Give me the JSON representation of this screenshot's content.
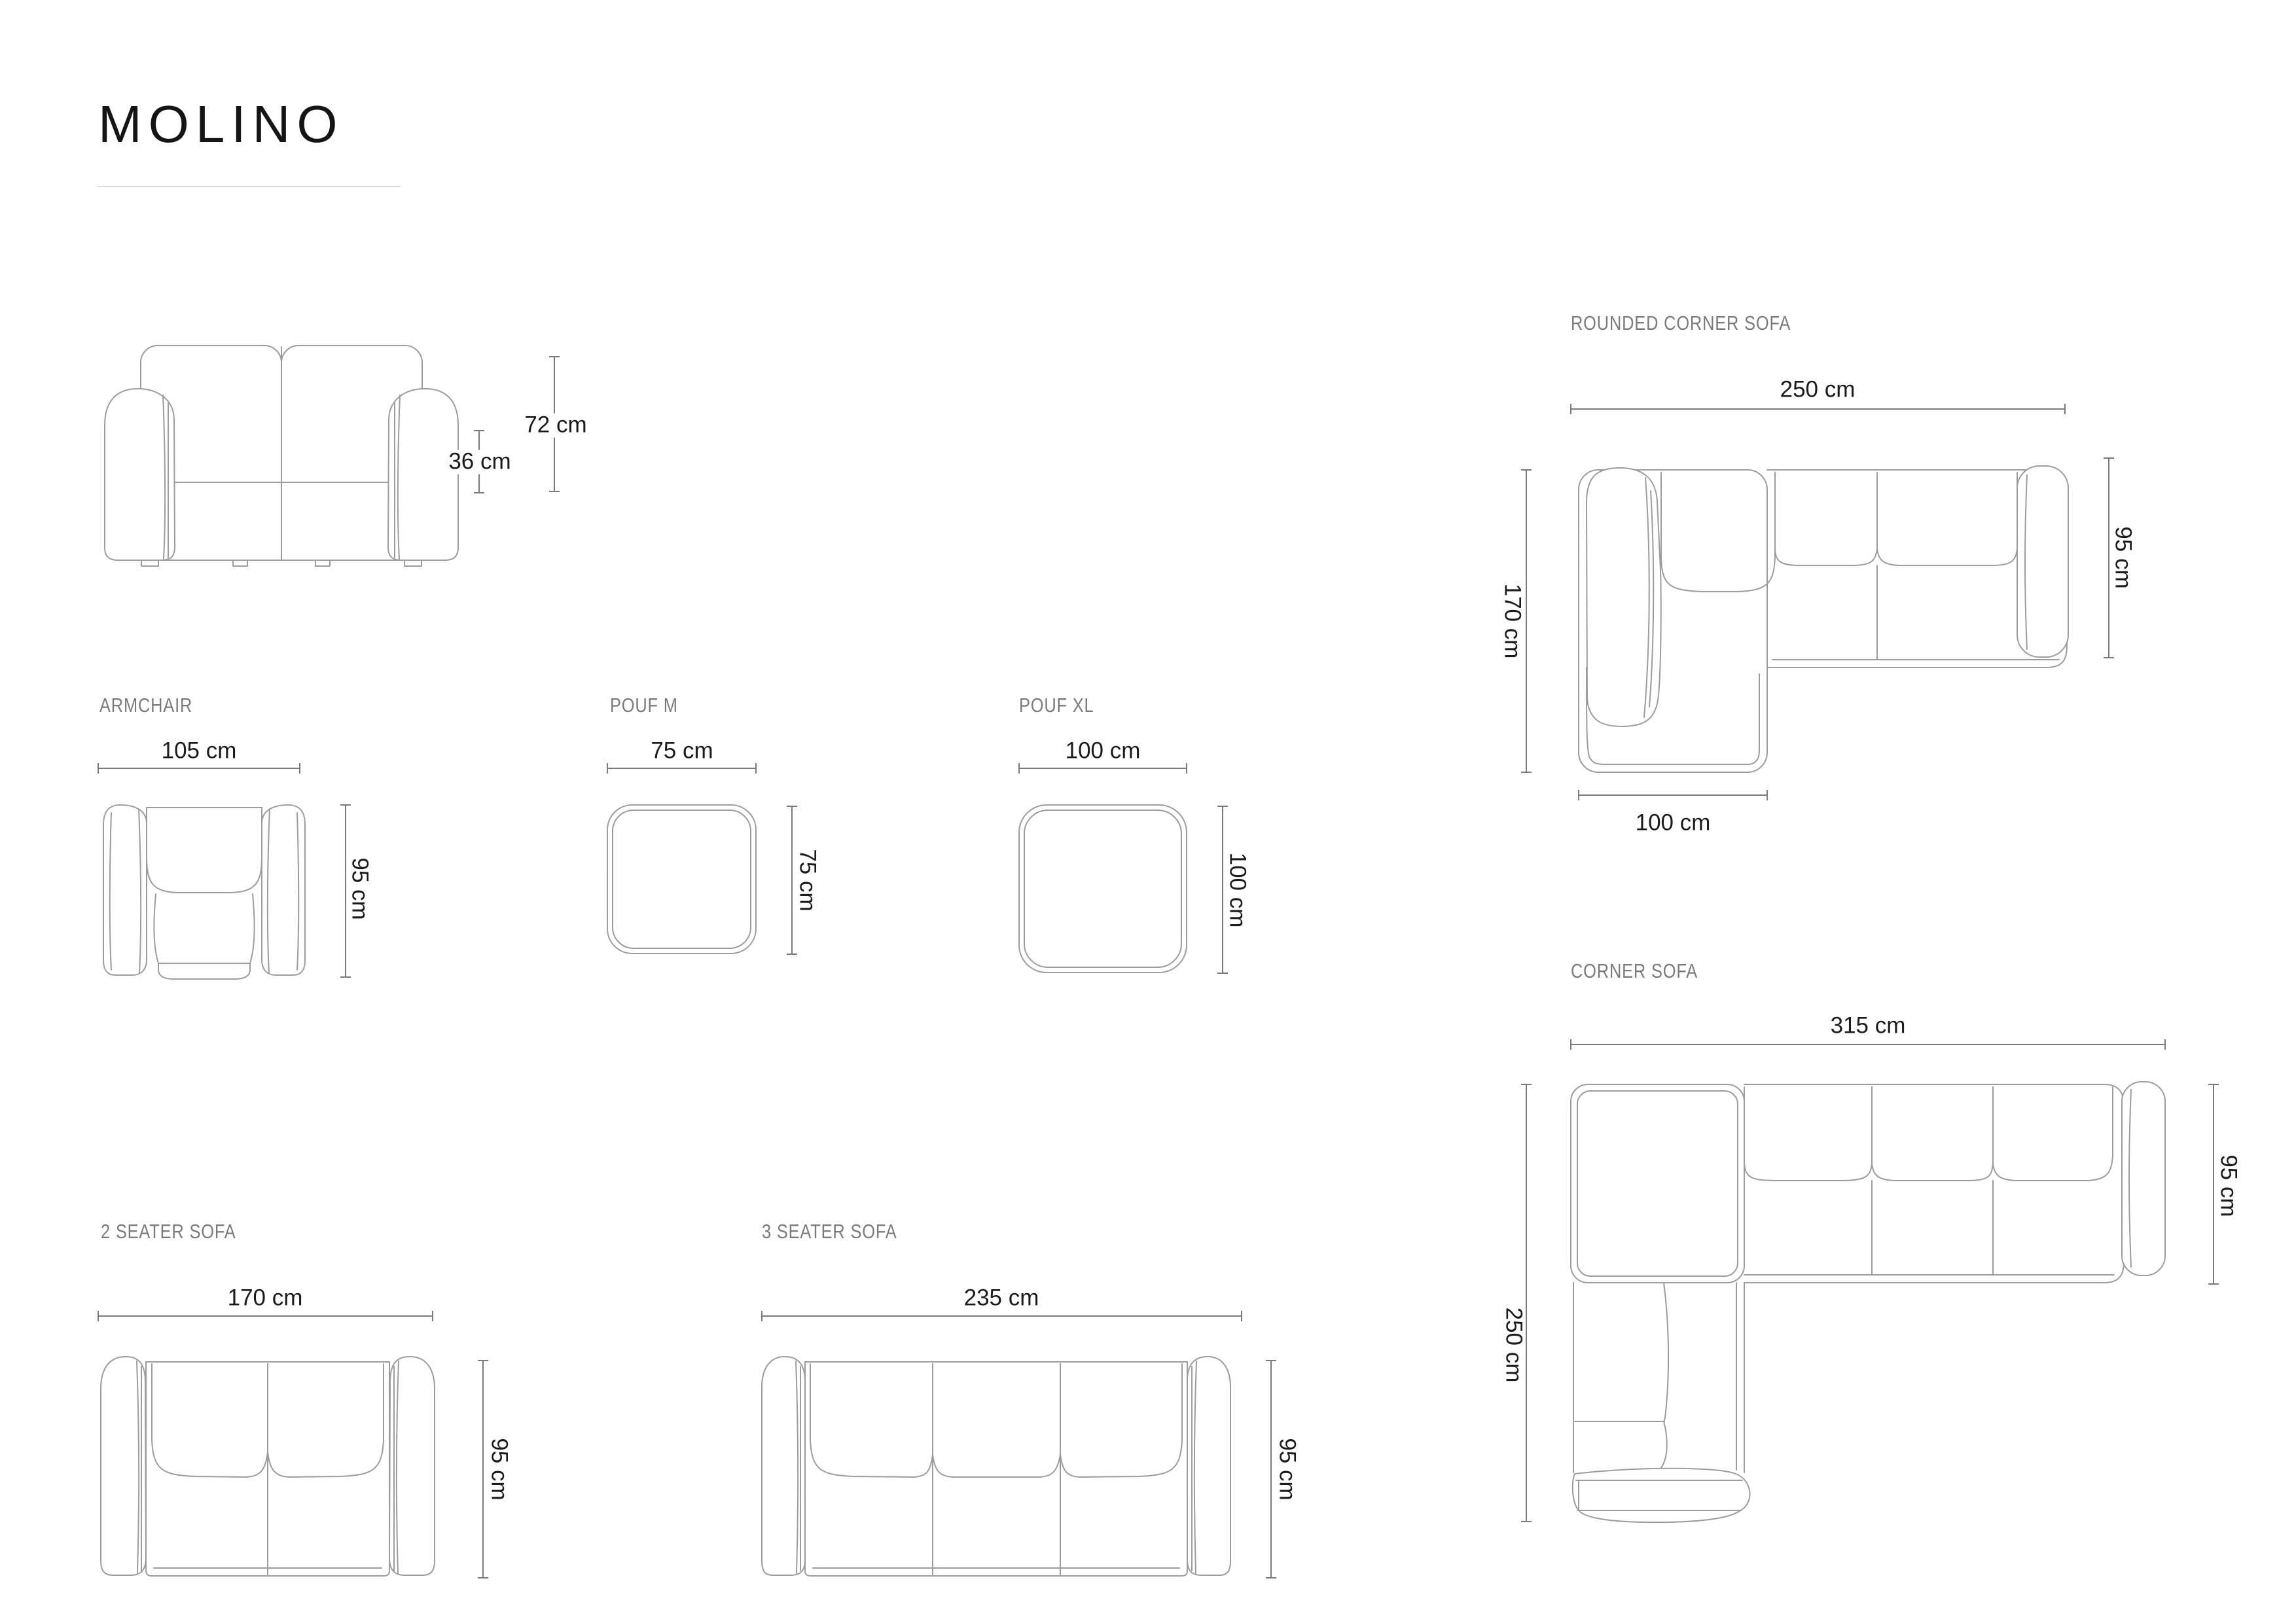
{
  "page": {
    "title": "MOLINO"
  },
  "colors": {
    "title_text": "#151515",
    "label_text": "#7a7a7a",
    "dimension_text": "#1b1b1b",
    "dimension_line": "#7a7a7a",
    "drawing_line": "#9c9c9c",
    "background": "#ffffff"
  },
  "products": {
    "front_view": {
      "dims": {
        "total_height": "72 cm",
        "seat_height": "36 cm"
      }
    },
    "rounded_corner_sofa": {
      "label": "ROUNDED CORNER SOFA",
      "dims": {
        "width": "250 cm",
        "depth": "95 cm",
        "chaise_length": "170 cm",
        "chaise_width": "100 cm"
      }
    },
    "armchair": {
      "label": "ARMCHAIR",
      "dims": {
        "width": "105 cm",
        "depth": "95 cm"
      }
    },
    "pouf_m": {
      "label": "POUF M",
      "dims": {
        "width": "75 cm",
        "depth": "75 cm"
      }
    },
    "pouf_xl": {
      "label": "POUF XL",
      "dims": {
        "width": "100 cm",
        "depth": "100 cm"
      }
    },
    "corner_sofa": {
      "label": "CORNER SOFA",
      "dims": {
        "width": "315 cm",
        "depth": "95 cm",
        "side_length": "250 cm"
      }
    },
    "two_seater_sofa": {
      "label": "2 SEATER SOFA",
      "dims": {
        "width": "170 cm",
        "depth": "95 cm"
      }
    },
    "three_seater_sofa": {
      "label": "3 SEATER SOFA",
      "dims": {
        "width": "235 cm",
        "depth": "95 cm"
      }
    }
  }
}
